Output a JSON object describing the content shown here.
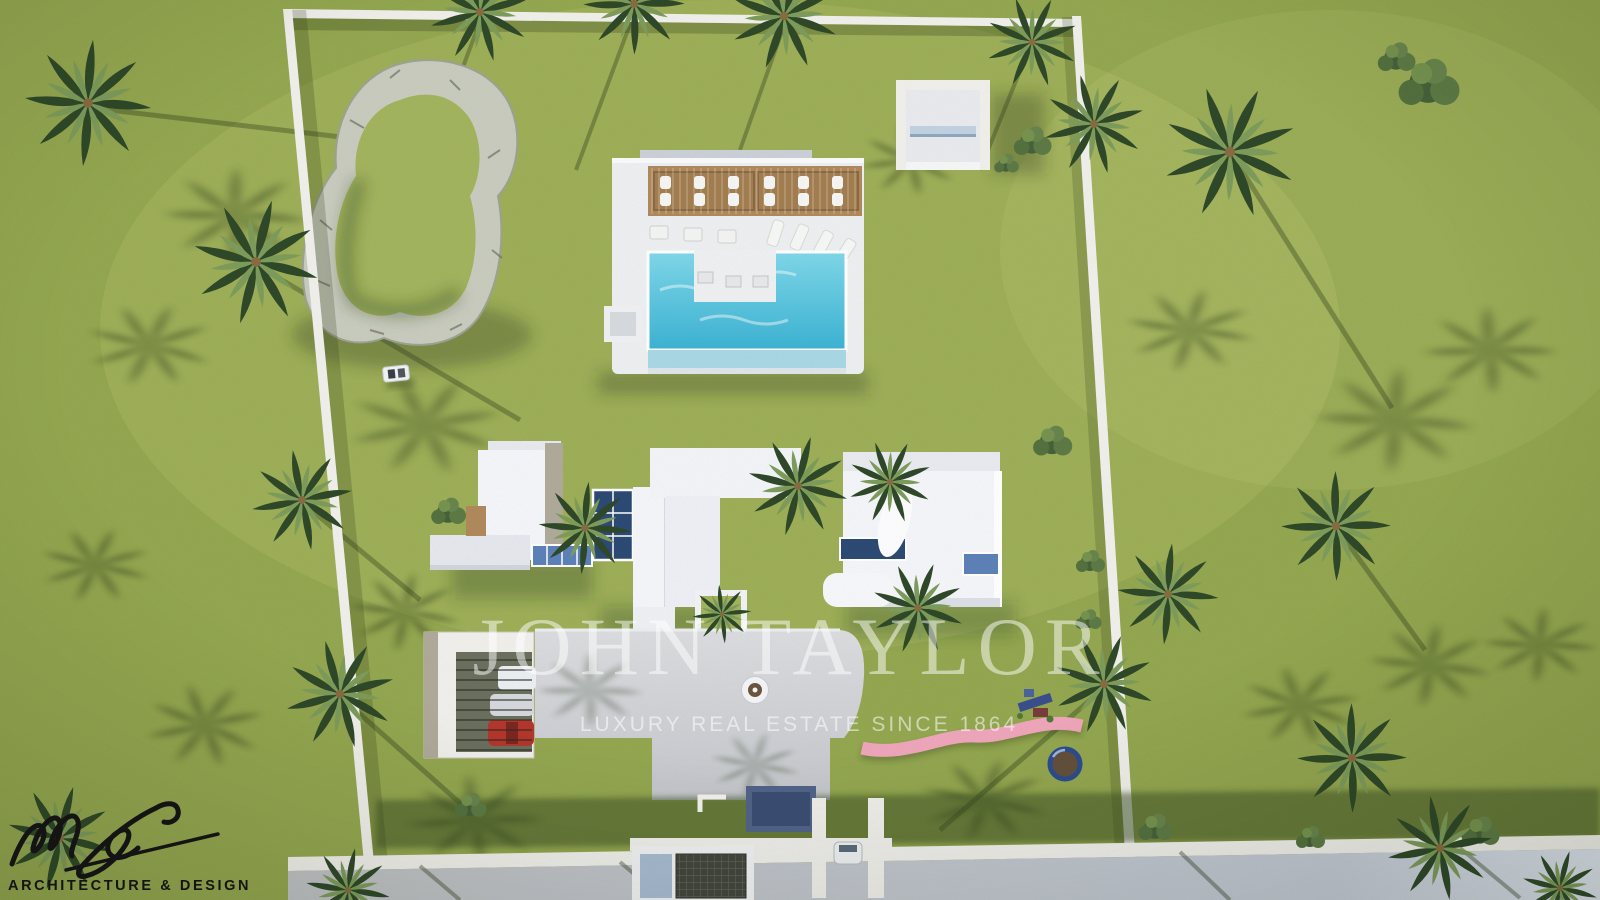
{
  "watermark": {
    "brand": "JOHN TAYLOR",
    "tagline": "LUXURY REAL ESTATE SINCE 1864"
  },
  "logo": {
    "initials": "ms",
    "caption": "ARCHITECTURE & DESIGN"
  },
  "scene": {
    "description": "Aerial 3D architectural rendering of a walled villa estate: modern white flat-roof villa, swimming pool with pergola and sun loungers, rock garden, carport with cars, driveway with fountain, playground with pink path and trampoline, entrance gate, lawns and palm trees",
    "objects": [
      "lawn",
      "perimeter-wall",
      "rock-garden",
      "swimming-pool",
      "pool-pergola",
      "sun-loungers",
      "pool-pavilion",
      "villa",
      "skylight",
      "courtyard-palm",
      "driveway",
      "fountain",
      "carport",
      "cars",
      "golf-cart",
      "playground",
      "pink-play-path",
      "trampoline",
      "entrance-gate",
      "access-road",
      "palm-trees",
      "bushes"
    ],
    "colors": {
      "lawn": "#94a750",
      "lawn-light": "#a3b45e",
      "lawn-shadow": "#4d6630",
      "wall": "#f1f0ec",
      "roof-white": "#f5f6fa",
      "roof-shade": "#d9dce3",
      "stone": "#b0aa9b",
      "glass": "#5d82b8",
      "glass-dark": "#2c4a74",
      "pool": "#4fc2dc",
      "pool-light": "#a9d8e4",
      "deck": "#eef0f2",
      "wood": "#b08a5c",
      "driveway": "#d2d3d7",
      "road": "#bfc2c6",
      "rock": "#c9ccbe",
      "pink-path": "#efa6bb",
      "car-red": "#b5362c",
      "car-silver": "#d6d9dd",
      "trampoline-ring": "#2c4d8e",
      "watermark": "rgba(255,255,255,0.5)",
      "watermark-soft": "rgba(255,255,255,0.55)",
      "logo-ink": "#141414"
    }
  }
}
